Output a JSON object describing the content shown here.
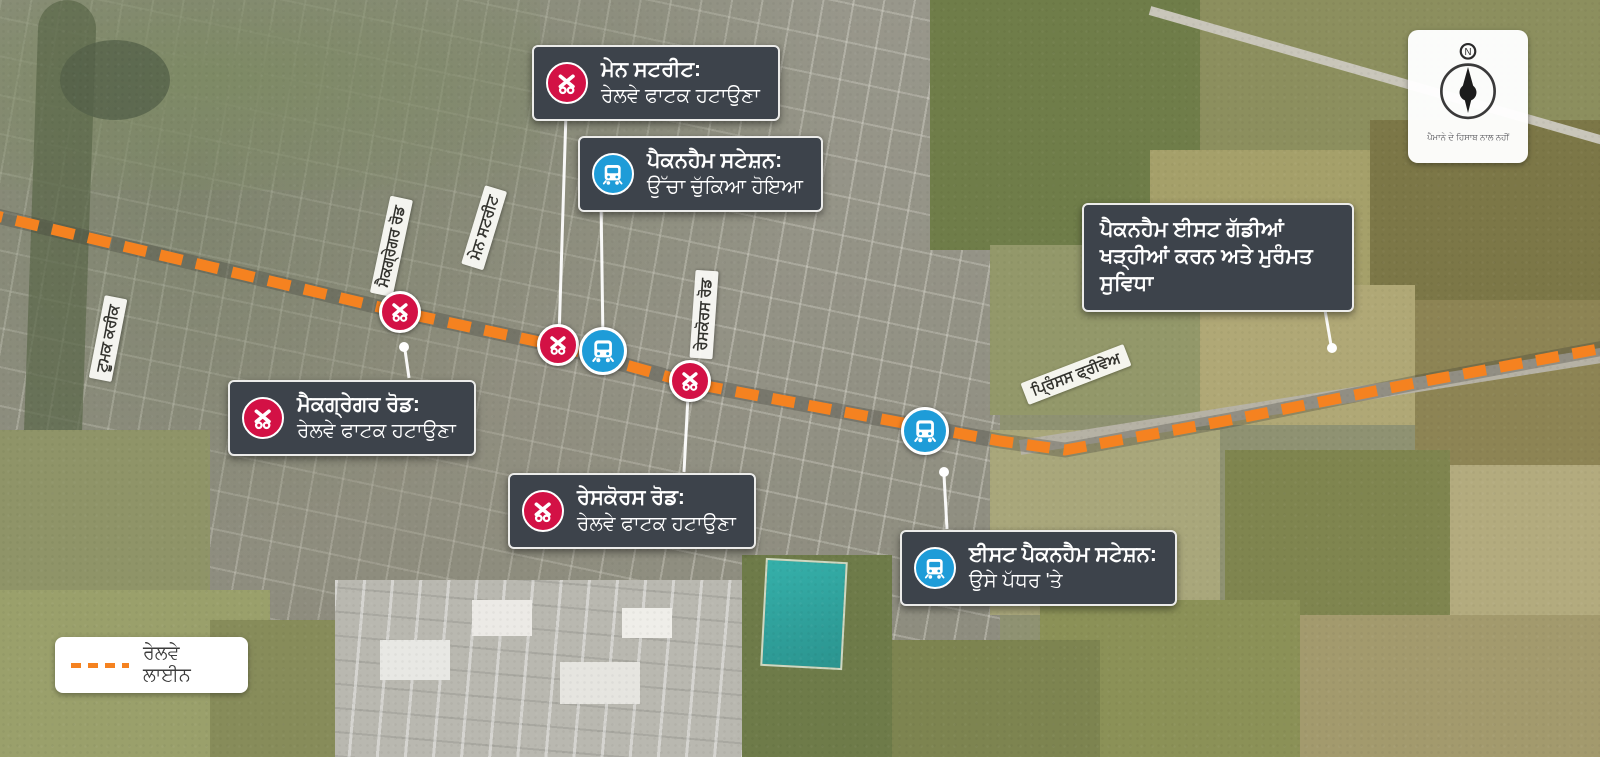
{
  "map": {
    "callouts": [
      {
        "id": "main-street",
        "title": "ਮੇਨ ਸਟਰੀਟ:",
        "subtitle": "ਰੇਲਵੇ ਫਾਟਕ ਹਟਾਉਣਾ",
        "icon": "level-crossing-icon",
        "marker_color": "#D31145"
      },
      {
        "id": "pakenham-station",
        "title": "ਪੈਕਨਹੈਮ ਸਟੇਸ਼ਨ:",
        "subtitle": "ਉੱਚਾ ਚੁੱਕਿਆ ਹੋਇਆ",
        "icon": "train-icon",
        "marker_color": "#1E9CD8"
      },
      {
        "id": "pakenham-east-facility",
        "title": "ਪੈਕਨਹੈਮ ਈਸਟ ਗੱਡੀਆਂ ਖੜ੍ਹੀਆਂ ਕਰਨ ਅਤੇ ਮੁਰੰਮਤ ਸੁਵਿਧਾ",
        "subtitle": "",
        "icon": null,
        "marker_color": null
      },
      {
        "id": "mcgregor-road",
        "title": "ਮੈਕਗ੍ਰੇਗਰ ਰੋਡ:",
        "subtitle": "ਰੇਲਵੇ ਫਾਟਕ ਹਟਾਉਣਾ",
        "icon": "level-crossing-icon",
        "marker_color": "#D31145"
      },
      {
        "id": "racecourse-road",
        "title": "ਰੇਸਕੋਰਸ ਰੋਡ:",
        "subtitle": "ਰੇਲਵੇ ਫਾਟਕ ਹਟਾਉਣਾ",
        "icon": "level-crossing-icon",
        "marker_color": "#D31145"
      },
      {
        "id": "east-pakenham-station",
        "title": "ਈਸਟ ਪੈਕਨਹੈਮ ਸਟੇਸ਼ਨ:",
        "subtitle": "ਉਸੇ ਪੱਧਰ 'ਤੇ",
        "icon": "train-icon",
        "marker_color": "#1E9CD8"
      }
    ],
    "road_labels": [
      {
        "text": "ਮੈਕਗ੍ਰੇਗਰ ਰੋਡ"
      },
      {
        "text": "ਮੇਨ ਸਟਰੀਟ"
      },
      {
        "text": "ਰੇਸਕੋਰਸ ਰੋਡ"
      },
      {
        "text": "ਟੂਮਕ ਕਰੀਕ"
      },
      {
        "text": "ਪ੍ਰਿੰਸਸ ਫ੍ਰੀਵੇਅ"
      }
    ],
    "legend": {
      "railway_label": "ਰੇਲਵੇ ਲਾਈਨ"
    },
    "compass": {
      "north_label": "N",
      "note": "ਪੈਮਾਨੇ ਦੇ ਹਿਸਾਬ ਨਾਲ ਨਹੀਂ"
    },
    "colors": {
      "railway_orange": "#F58220",
      "crossing_red": "#D31145",
      "station_blue": "#1E9CD8",
      "callout_bg": "#3D434B"
    }
  }
}
